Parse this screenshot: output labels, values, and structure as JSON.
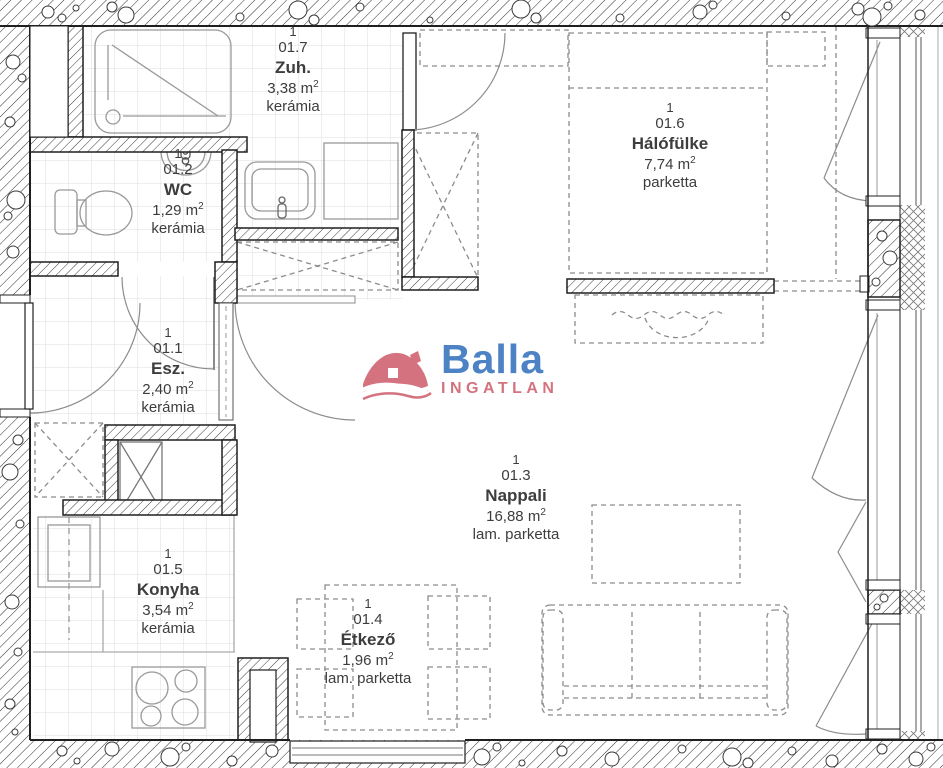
{
  "page": {
    "background": "#ffffff",
    "wall_line_color": "#1f1f1f",
    "furniture_color": "#8c8c8c",
    "grid_color": "#dcdcdc",
    "text_color": "#3d3d3d"
  },
  "units": {
    "exponent": "2"
  },
  "logo": {
    "brand": "Balla",
    "subtitle": "INGATLAN",
    "brand_color": "#4d83c4",
    "accent_color": "#d4737f"
  },
  "rooms": [
    {
      "key": "zuh",
      "count": "1",
      "code": "01.7",
      "name": "Zuh.",
      "area": "3,38 m",
      "floor": "kerámia"
    },
    {
      "key": "wc",
      "count": "1",
      "code": "01.2",
      "name": "WC",
      "area": "1,29 m",
      "floor": "kerámia"
    },
    {
      "key": "halofulke",
      "count": "1",
      "code": "01.6",
      "name": "Hálófülke",
      "area": "7,74 m",
      "floor": "parketta"
    },
    {
      "key": "esz",
      "count": "1",
      "code": "01.1",
      "name": "Esz.",
      "area": "2,40 m",
      "floor": "kerámia"
    },
    {
      "key": "nappali",
      "count": "1",
      "code": "01.3",
      "name": "Nappali",
      "area": "16,88 m",
      "floor": "lam. parketta"
    },
    {
      "key": "konyha",
      "count": "1",
      "code": "01.5",
      "name": "Konyha",
      "area": "3,54 m",
      "floor": "kerámia"
    },
    {
      "key": "etkezo",
      "count": "1",
      "code": "01.4",
      "name": "Étkező",
      "area": "1,96 m",
      "floor": "lam. parketta"
    }
  ]
}
